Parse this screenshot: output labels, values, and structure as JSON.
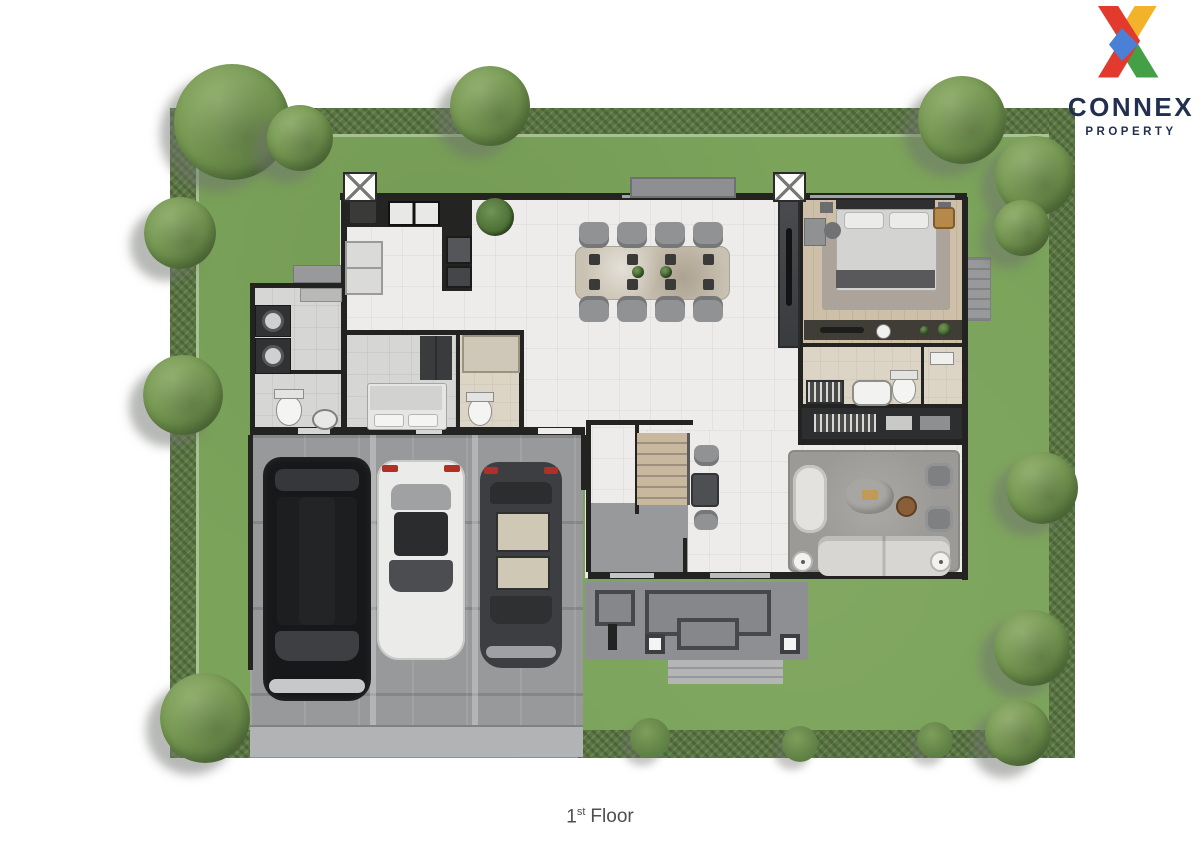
{
  "logo": {
    "icon": "connex-x-mark",
    "brand": "CONNEX",
    "tagline": "PROPERTY"
  },
  "caption": {
    "number": "1",
    "ordinal": "st",
    "text": "Floor"
  },
  "palette": {
    "wall": "#232321",
    "floor_white": "#edecea",
    "floor_gray": "#d6d6d4",
    "wood": "#cdbfa8",
    "beige": "#dcd4c5",
    "lawn": "#7ba35a",
    "hedge": "#5a7742",
    "concrete": "#98999b",
    "porch": "#8e8f92",
    "apron": "#b2b3b5",
    "dark_cabinet": "#3a3b3e",
    "logo_red": "#e23b2e",
    "logo_yellow": "#f2b32a",
    "logo_green": "#43a047",
    "logo_blue": "#4a80d6",
    "logo_navy": "#223050",
    "caption_color": "#4c514c"
  }
}
